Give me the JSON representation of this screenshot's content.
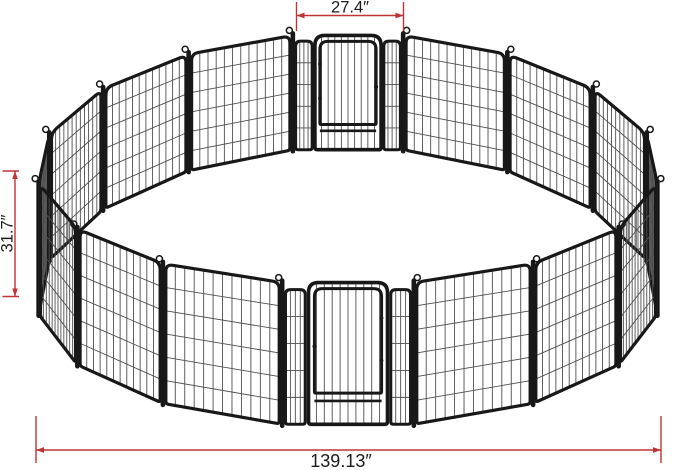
{
  "diagram": {
    "subject": "16-panel metal pet playpen arranged in a circle with two walk-through door panels",
    "panel_count": 16,
    "door_count": 2,
    "measurements": {
      "door_panel_width": "27.4″",
      "panel_height": "31.7″",
      "overall_width": "139.13″"
    },
    "colors": {
      "dimension": "#c23333",
      "frame": "#181818",
      "mesh": "#4f4f4f",
      "background": "#ffffff",
      "label_text": "#1c1c1c"
    }
  }
}
